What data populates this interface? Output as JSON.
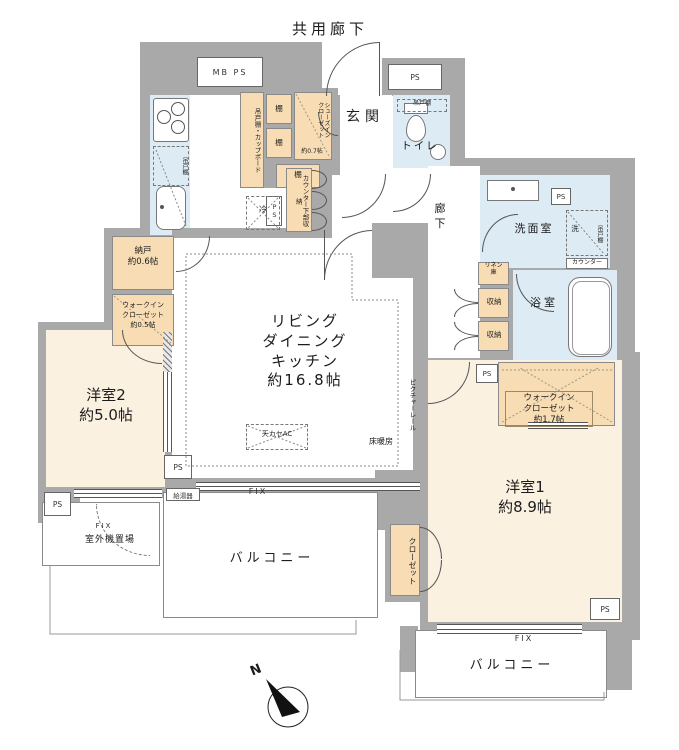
{
  "colors": {
    "wall": "#a9a9a9",
    "room_cream": "#fbf1e1",
    "closet_orange": "#f8ddb4",
    "wet_blue": "#dcebf4",
    "line": "#555555"
  },
  "labels": {
    "common_corridor": "共用廊下",
    "mb_ps": "MB PS",
    "ps": "PS",
    "shelf": "棚",
    "cupboard_strip": "吊戸棚・カップボード",
    "hanging_cupboard": "吊戸棚",
    "shoes_closet": "シューズイン\nクローゼット",
    "shoes_closet_size": "約0.7帖",
    "entrance": "玄関",
    "toilet": "トイレ",
    "corridor": "廊\n下",
    "washroom": "洗面室",
    "wash": "洗",
    "counter": "カウンター",
    "bath": "浴室",
    "linen": "リネン\n庫",
    "storage": "収納",
    "counter_under": "カウンター下部収納",
    "fridge": "冷",
    "ldk": "リビング\nダイニング\nキッチン\n約16.8帖",
    "picture_rail": "ピクチャーレール",
    "ceiling_ac": "天カセAC",
    "floor_heating": "床暖房",
    "nando": "納戸\n約0.6帖",
    "wic05": "ウォークイン\nクローゼット\n約0.5帖",
    "wic17": "ウォークイン\nクローゼット\n約1.7帖",
    "room2": "洋室2\n約5.0帖",
    "room1": "洋室1\n約8.9帖",
    "water_heater": "給湯器",
    "fix": "FIX",
    "outdoor_unit": "室外機置場",
    "balcony": "バルコニー",
    "closet": "クローゼット",
    "north": "N"
  }
}
